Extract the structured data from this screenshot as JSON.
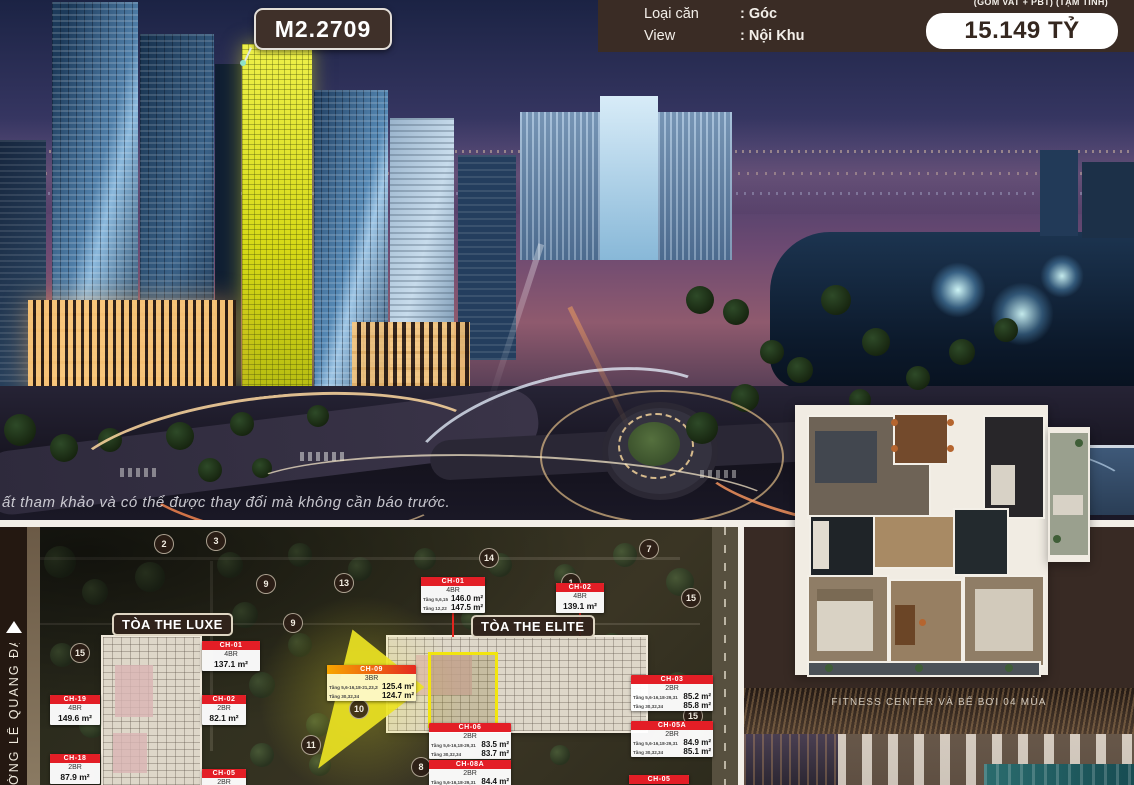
{
  "badge": {
    "unit_code": "M2.2709"
  },
  "info_bar": {
    "rows": [
      {
        "label": "Loại căn",
        "value": ": Góc"
      },
      {
        "label": "View",
        "value": ": Nội Khu"
      }
    ],
    "price_note": "(GỒM VAT + PBT) (TẠM TÍNH)",
    "price": "15.149 TỶ"
  },
  "watermark": "ất tham khảo và có thể được thay đổi mà không cần báo trước.",
  "site_map": {
    "street_label": "ỜNG LÊ QUANG ĐẠO",
    "towers": [
      {
        "label": "TÒA THE LUXE"
      },
      {
        "label": "TÒA THE ELITE"
      }
    ],
    "unit_cards": [
      {
        "id": "CH-01",
        "bedrooms": "4BR",
        "rows": [
          {
            "floors": "Tầng 5,6,15",
            "area": "146.0 m²"
          },
          {
            "floors": "Tầng 12,22",
            "area": "147.5 m²"
          }
        ],
        "x": 421,
        "y": 577,
        "w": 64,
        "style": "red"
      },
      {
        "id": "CH-02",
        "bedrooms": "4BR",
        "rows": [
          {
            "floors": "",
            "area": "139.1 m²"
          }
        ],
        "x": 556,
        "y": 583,
        "w": 48,
        "style": "red"
      },
      {
        "id": "CH-01",
        "bedrooms": "4BR",
        "rows": [
          {
            "floors": "",
            "area": "137.1 m²"
          }
        ],
        "x": 202,
        "y": 641,
        "w": 58,
        "style": "red"
      },
      {
        "id": "CH-09",
        "bedrooms": "3BR",
        "rows": [
          {
            "floors": "Tầng 5,6-16,18-21,23,25",
            "area": "125.4 m²"
          },
          {
            "floors": "Tầng 30,32,34",
            "area": "124.7 m²"
          }
        ],
        "x": 327,
        "y": 665,
        "w": 89,
        "style": "highlight"
      },
      {
        "id": "CH-19",
        "bedrooms": "4BR",
        "rows": [
          {
            "floors": "",
            "area": "149.6 m²"
          }
        ],
        "x": 50,
        "y": 695,
        "w": 50,
        "style": "red"
      },
      {
        "id": "CH-02",
        "bedrooms": "2BR",
        "rows": [
          {
            "floors": "",
            "area": "82.1 m²"
          }
        ],
        "x": 202,
        "y": 695,
        "w": 44,
        "style": "red"
      },
      {
        "id": "CH-18",
        "bedrooms": "2BR",
        "rows": [
          {
            "floors": "",
            "area": "87.9 m²"
          }
        ],
        "x": 50,
        "y": 754,
        "w": 50,
        "style": "red"
      },
      {
        "id": "CH-05",
        "bedrooms": "2BR",
        "rows": [],
        "x": 202,
        "y": 769,
        "w": 44,
        "style": "red"
      },
      {
        "id": "CH-03",
        "bedrooms": "2BR",
        "rows": [
          {
            "floors": "Tầng 5,6-16,18-29,31,33,35",
            "area": "85.2 m²"
          },
          {
            "floors": "Tầng 30,32,34",
            "area": "85.8 m²"
          }
        ],
        "x": 631,
        "y": 675,
        "w": 82,
        "style": "red"
      },
      {
        "id": "CH-05A",
        "bedrooms": "2BR",
        "rows": [
          {
            "floors": "Tầng 5,6-16,18-29,31,33,35",
            "area": "84.9 m²"
          },
          {
            "floors": "Tầng 30,32,34",
            "area": "85.1 m²"
          }
        ],
        "x": 631,
        "y": 721,
        "w": 82,
        "style": "red"
      },
      {
        "id": "CH-06",
        "bedrooms": "2BR",
        "rows": [
          {
            "floors": "Tầng 5,6-16,18-29,31,33,35",
            "area": "83.5 m²"
          },
          {
            "floors": "Tầng 30,32,34",
            "area": "83.7 m²"
          }
        ],
        "x": 429,
        "y": 723,
        "w": 82,
        "style": "red"
      },
      {
        "id": "CH-08A",
        "bedrooms": "2BR",
        "rows": [
          {
            "floors": "Tầng 5,6-16,18-29,31,33,35",
            "area": "84.4 m²"
          }
        ],
        "x": 429,
        "y": 760,
        "w": 82,
        "style": "red"
      },
      {
        "id": "CH-05",
        "bedrooms": "",
        "rows": [],
        "x": 629,
        "y": 775,
        "w": 60,
        "style": "red"
      }
    ],
    "markers": [
      {
        "n": "2",
        "x": 163,
        "y": 543
      },
      {
        "n": "3",
        "x": 215,
        "y": 540
      },
      {
        "n": "15",
        "x": 79,
        "y": 652
      },
      {
        "n": "9",
        "x": 265,
        "y": 583
      },
      {
        "n": "13",
        "x": 343,
        "y": 582
      },
      {
        "n": "14",
        "x": 488,
        "y": 557
      },
      {
        "n": "9",
        "x": 292,
        "y": 622
      },
      {
        "n": "7",
        "x": 648,
        "y": 548
      },
      {
        "n": "15",
        "x": 690,
        "y": 597
      },
      {
        "n": "1",
        "x": 570,
        "y": 582
      },
      {
        "n": "10",
        "x": 358,
        "y": 708
      },
      {
        "n": "11",
        "x": 310,
        "y": 744
      },
      {
        "n": "8",
        "x": 420,
        "y": 766
      },
      {
        "n": "15",
        "x": 692,
        "y": 715
      }
    ]
  },
  "fitness": {
    "caption": "FITNESS CENTER VÀ BỂ BƠI 04 MÙA"
  },
  "colors": {
    "accent_red": "#e31e26",
    "highlight_yellow": "#f2e50e",
    "brand_brown": "#3a2c25"
  }
}
